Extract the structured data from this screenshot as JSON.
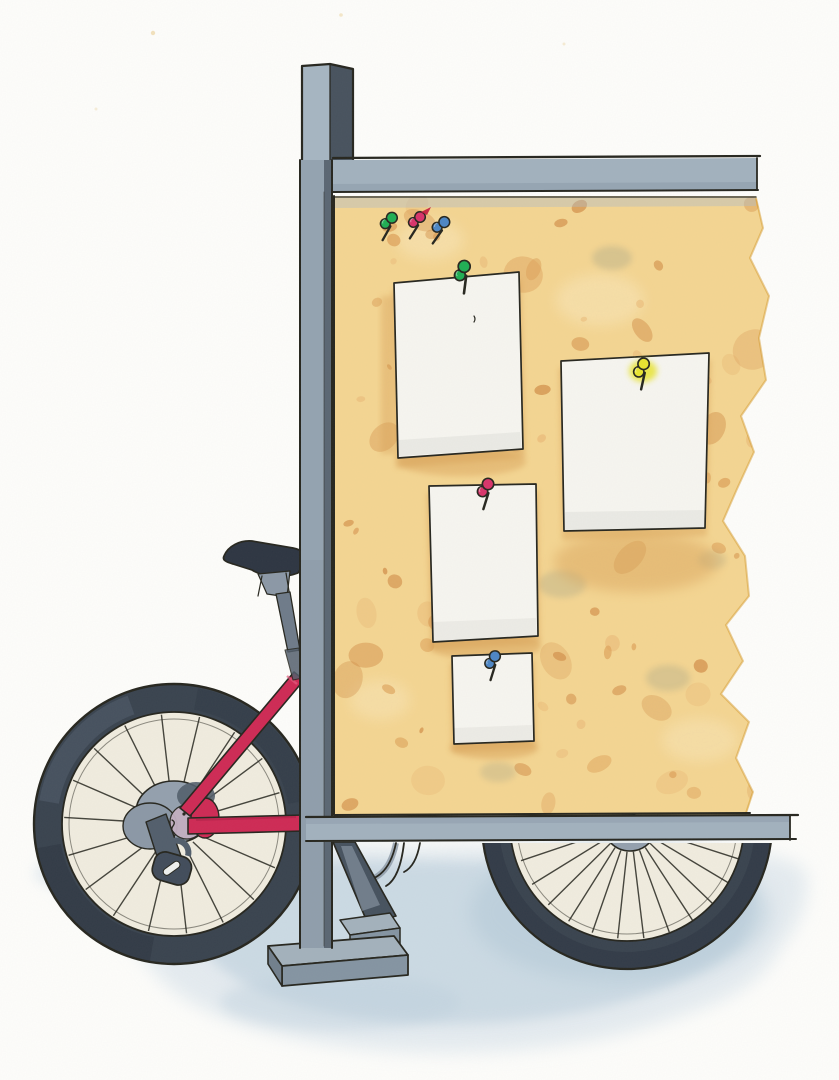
{
  "scene": {
    "type": "watercolor illustration",
    "description": "A pink bicycle leans locked against a gray steel signpost that holds a tan cork notice board. Four blank white notes are pinned to the cork with green, yellow, pink and blue pushpins; three spare pushpins (green, pink, blue) rest near the top of the board. A soft blue shadow wash lies on the ground beneath the bicycle and board.",
    "objects": {
      "notice_board": {
        "notes_count": 4,
        "pinned_pin_colors": [
          "green",
          "yellow",
          "pink",
          "blue"
        ]
      },
      "loose_pins": {
        "count": 3,
        "colors": [
          "green",
          "pink",
          "blue"
        ]
      },
      "bicycle": {
        "frame_color_name": "pink",
        "visible_wheels": 2,
        "accessories": [
          "saddle",
          "wheel lock"
        ]
      },
      "signpost": {
        "material_look": "steel",
        "base": "rectangular plate with step"
      }
    }
  },
  "render": {
    "seed": 7,
    "cork_speckles_large": 26,
    "cork_speckles_small": 64,
    "rear_spokes": 18,
    "front_spokes": 12
  },
  "palette": {
    "paper_bg": "#fdfdfb",
    "ink": "#26261f",
    "wash_light": "#d5e1ea",
    "wash_mid": "#bccfdd",
    "wash_deep": "#a9c2d3",
    "tire": "#39434f",
    "tire_dark": "#2b3440",
    "tire_light": "#5a6778",
    "wheel_inner": "#f0ecdf",
    "hub_gray": "#93a0ae",
    "hub_dark": "#525e6c",
    "hub_disc": "#c2afc2",
    "lock_body": "#414c5b",
    "frame_pink": "#ce2a55",
    "frame_pink_dark": "#a81d44",
    "frame_pink_light": "#e25a7e",
    "saddle": "#2d3542",
    "post_gray": "#6e7b8a",
    "clamp_gray": "#8b98a6",
    "pole_light": "#a6b5c2",
    "pole_mid": "#93a3b1",
    "pole_dark": "#47525e",
    "pole_side": "#5a6673",
    "rail": "#a2b1be",
    "rail_shade": "#8c9cab",
    "base_top": "#a3b1bc",
    "base_front": "#8494a2",
    "base_side": "#717f8d",
    "gusset": "#46525f",
    "cork": "#f5d692",
    "cork_light": "#fae8bd",
    "cork_speck1": "#eab977",
    "cork_speck2": "#dd9f58",
    "cork_speck3": "#d18b45",
    "cork_edge": "#d1921f",
    "cork_smudge": "#a3a388",
    "cork_shadow_rail": "#aebccb",
    "paper_white": "#f6f5f0",
    "paper_shade": "#e6e5df",
    "paper_shadow": "#d8a158",
    "pin_green": "#1fae54",
    "pin_pink": "#d8346b",
    "pin_red": "#c3173d",
    "pin_blue": "#4d86c5",
    "pin_yellow": "#e8e430",
    "speck_margin": "#e9cb8b"
  }
}
